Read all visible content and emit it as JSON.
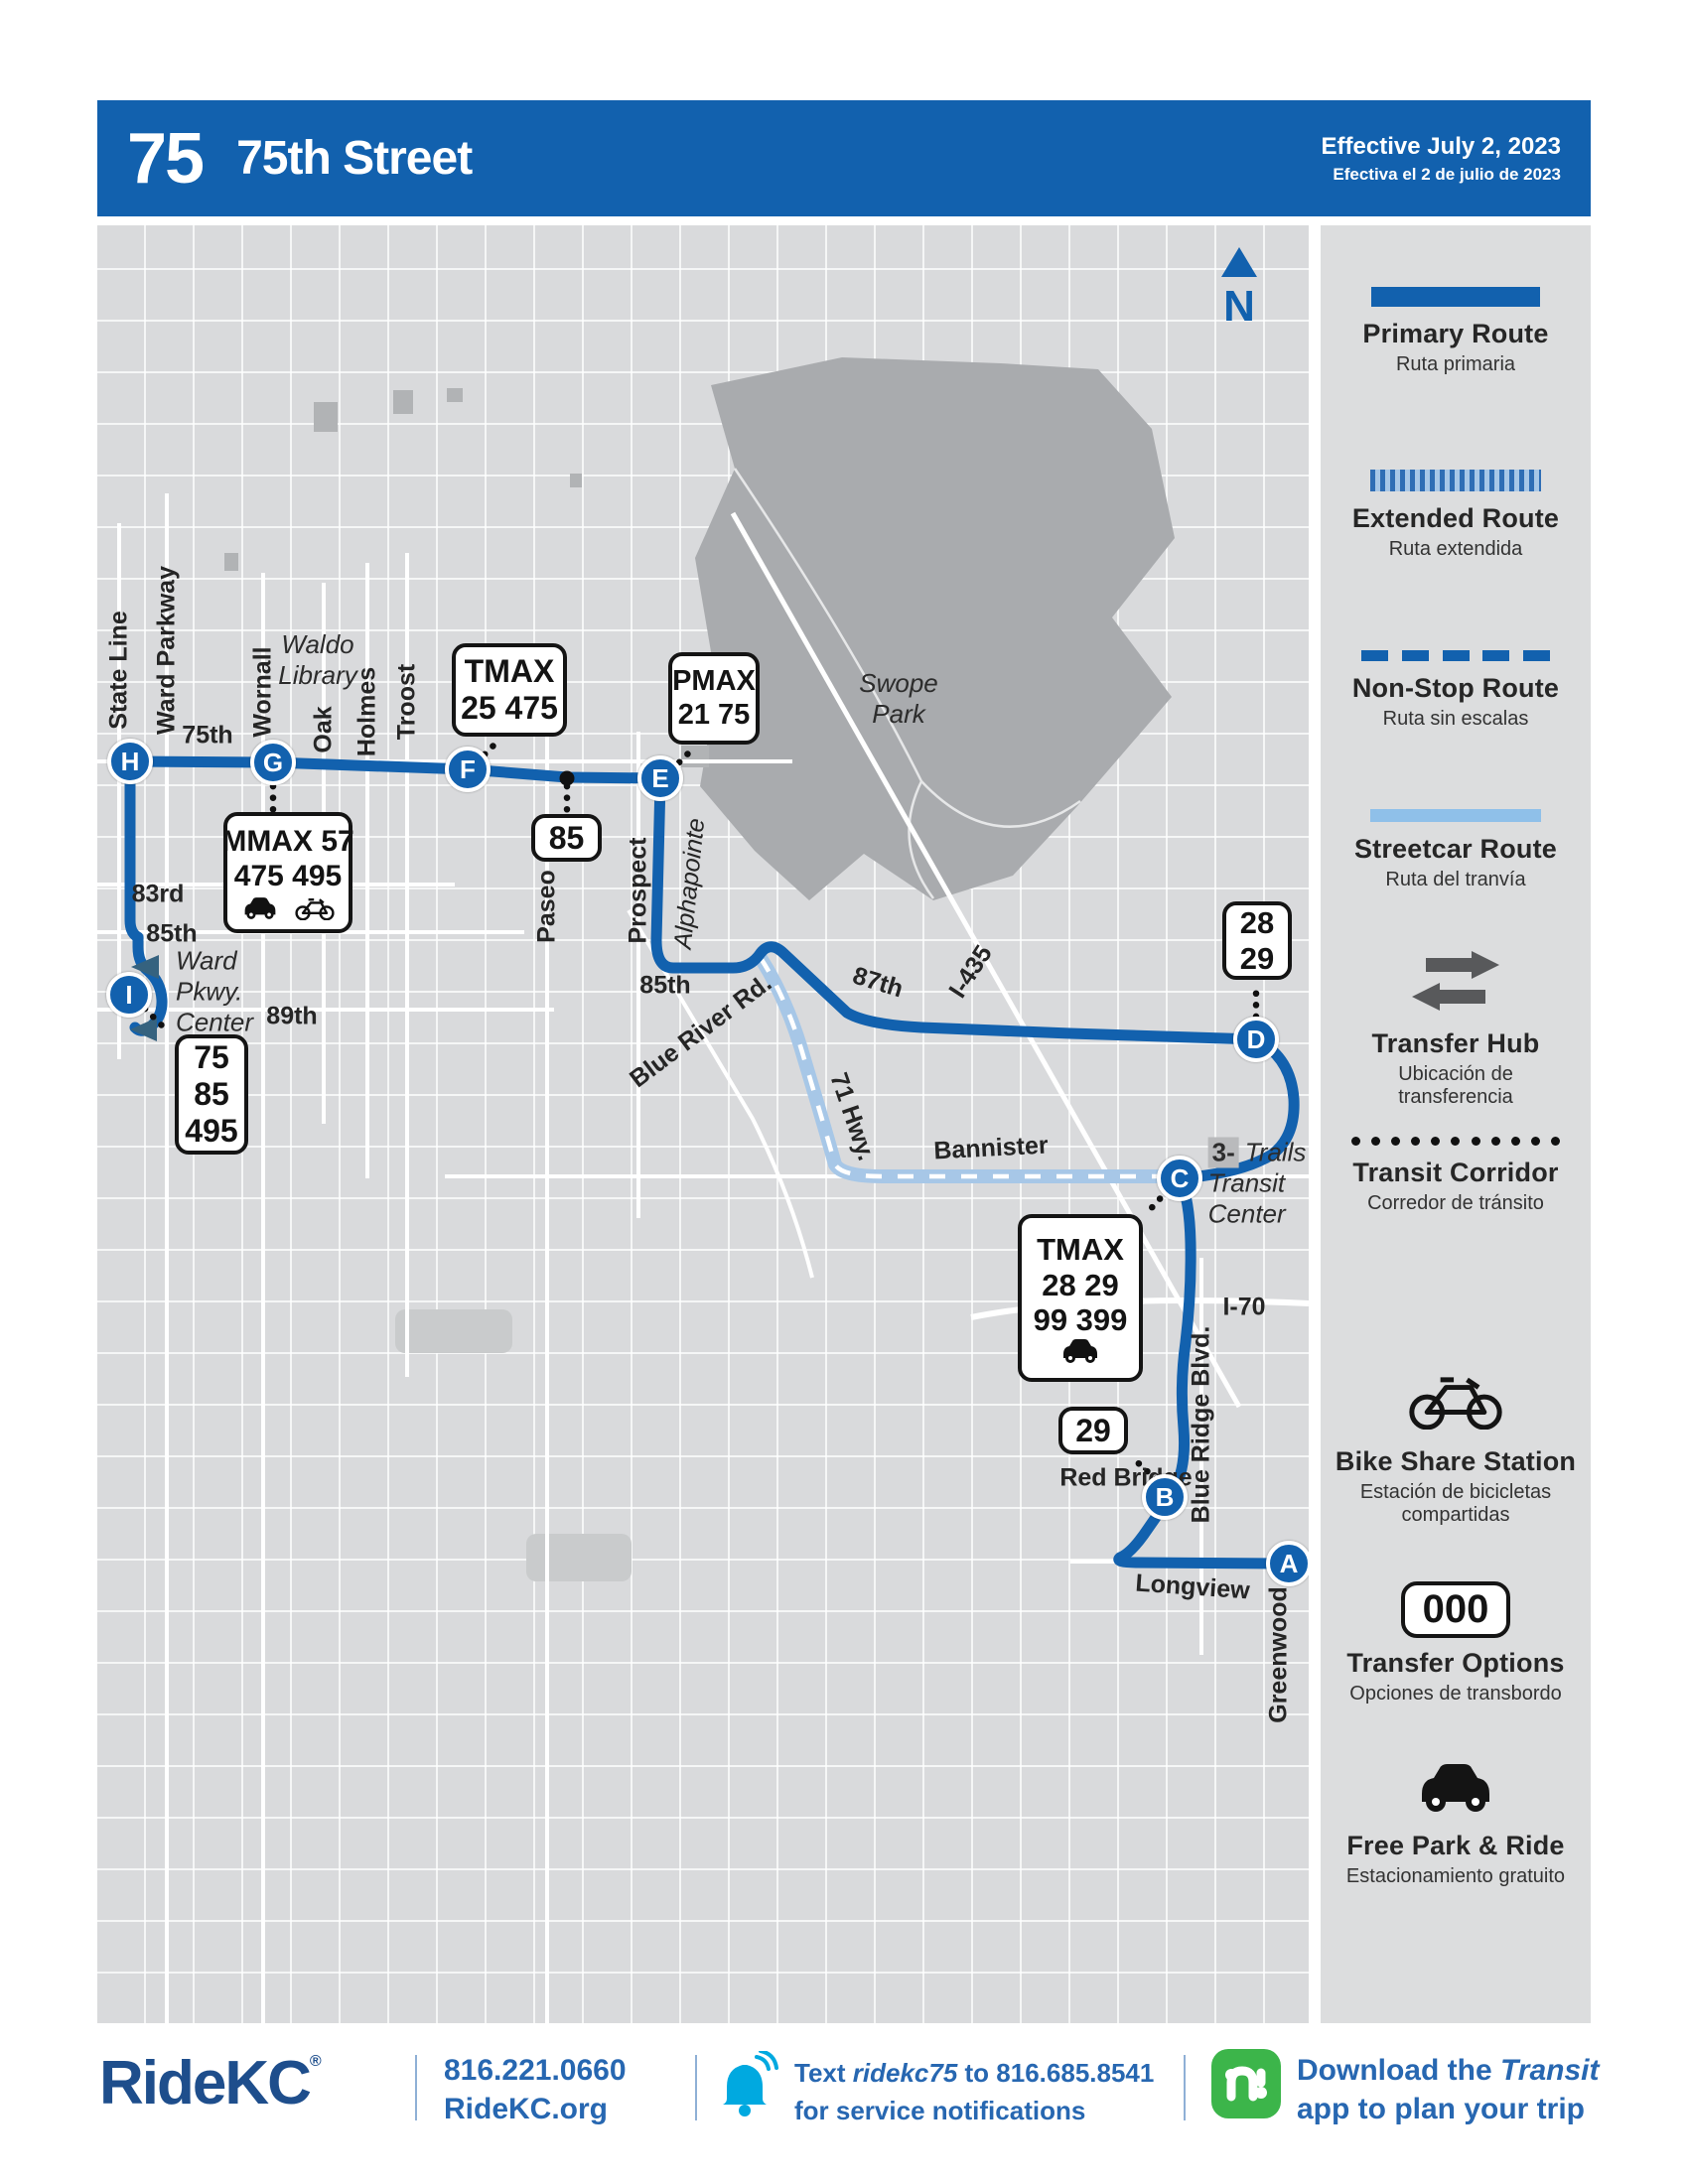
{
  "header": {
    "route_number": "75",
    "route_name": "75th Street",
    "effective_en": "Effective July 2, 2023",
    "effective_es": "Efectiva el 2 de julio de 2023"
  },
  "map": {
    "north": "N",
    "stops": {
      "a": "A",
      "b": "B",
      "c": "C",
      "d": "D",
      "e": "E",
      "f": "F",
      "g": "G",
      "h": "H",
      "i": "I"
    },
    "streets": {
      "state_line": "State Line",
      "ward_parkway": "Ward Parkway",
      "wornall": "Wornall",
      "oak": "Oak",
      "holmes": "Holmes",
      "troost": "Troost",
      "paseo": "Paseo",
      "prospect": "Prospect",
      "alphapointe": "Alphapointe",
      "blue_ridge": "Blue Ridge Blvd.",
      "greenwood": "Greenwood",
      "s75th": "75th",
      "s83rd": "83rd",
      "s85th_w": "85th",
      "s89th": "89th",
      "s85th_e": "85th",
      "blue_river": "Blue River Rd.",
      "hwy71": "71 Hwy.",
      "s87th": "87th",
      "i435": "I-435",
      "bannister": "Bannister",
      "i70": "I-70",
      "longview": "Longview"
    },
    "places": {
      "waldo": "Waldo\nLibrary",
      "swope": "Swope\nPark",
      "ward_center": "Ward\nPkwy.\nCenter",
      "trails_chip": "3-",
      "trails_1": "Trails",
      "trails_2": "Transit",
      "trails_3": "Center"
    },
    "boxes": {
      "tmax_north": [
        "TMAX",
        "25  475"
      ],
      "pmax": [
        "PMAX",
        "21  75"
      ],
      "paseo85": [
        "85"
      ],
      "d_transfers": [
        "28",
        "29"
      ],
      "tmax_south": [
        "TMAX",
        "28  29",
        "99  399"
      ],
      "red_bridge": [
        "29"
      ],
      "ward_transfers": [
        "75",
        "85",
        "495"
      ],
      "mmax": [
        "MMAX  57",
        "475  495"
      ]
    }
  },
  "legend": {
    "items": [
      {
        "title": "Primary Route",
        "subtitle": "Ruta primaria"
      },
      {
        "title": "Extended Route",
        "subtitle": "Ruta extendida"
      },
      {
        "title": "Non-Stop Route",
        "subtitle": "Ruta sin escalas"
      },
      {
        "title": "Streetcar Route",
        "subtitle": "Ruta del tranvía"
      },
      {
        "title": "Transfer Hub",
        "subtitle": "Ubicación de\ntransferencia"
      },
      {
        "title": "Transit Corridor",
        "subtitle": "Corredor de tránsito"
      },
      {
        "title": "Bike Share Station",
        "subtitle": "Estación de bicicletas\ncompartidas"
      },
      {
        "title": "Transfer Options",
        "subtitle": "Opciones de transbordo",
        "badge": "000"
      },
      {
        "title": "Free Park & Ride",
        "subtitle": "Estacionamiento gratuito"
      }
    ]
  },
  "footer": {
    "brand": "RideKC",
    "trademark": "®",
    "phone": "816.221.0660",
    "website": "RideKC.org",
    "notify_prefix": "Text ",
    "notify_keyword": "ridekc75",
    "notify_mid": " to ",
    "notify_number": "816.685.8541",
    "notify_line2": "for service notifications",
    "download_prefix": "Download the ",
    "download_app": "Transit",
    "download_line2": "app to plan your trip"
  }
}
